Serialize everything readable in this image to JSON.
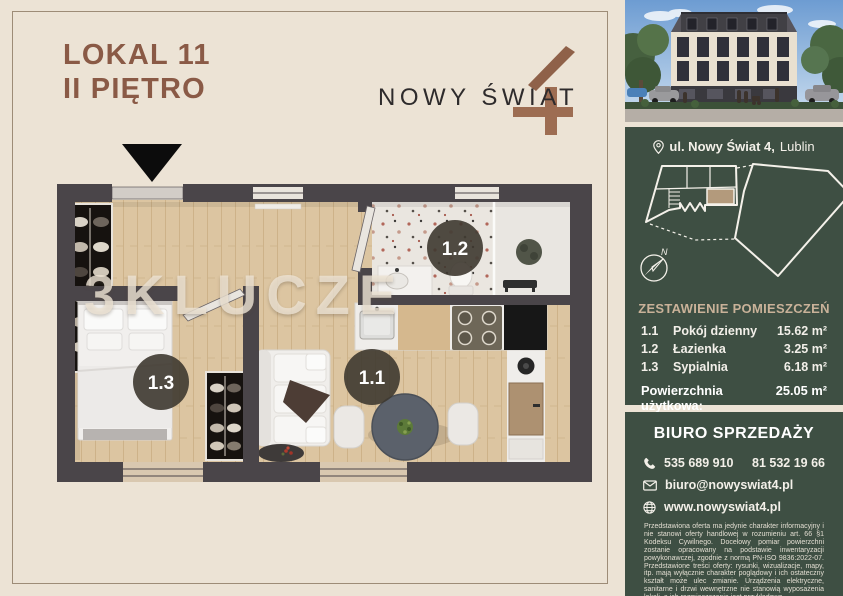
{
  "colors": {
    "background": "#ece3d5",
    "panel_green": "#3e4f43",
    "accent_tan": "#c9b299",
    "title_brown": "#8a5a46",
    "logo_brown": "#9d6d52",
    "wall_dark": "#4a4549",
    "wood_floor": "#dcc5a1"
  },
  "header": {
    "line1": "LOKAL 11",
    "line2": "II PIĘTRO"
  },
  "logo": {
    "wordmark": "NOWY ŚWIAT",
    "numeral": "4"
  },
  "floorplan": {
    "watermark": "3KLUCZE",
    "badges": {
      "living": "1.1",
      "bathroom": "1.2",
      "bedroom": "1.3"
    }
  },
  "sidebar": {
    "address": {
      "street_bold": "ul. Nowy Świat 4,",
      "city": "Lublin"
    },
    "siteplan": {
      "north_label": "N"
    },
    "rooms": {
      "heading": "ZESTAWIENIE POMIESZCZEŃ",
      "rows": [
        {
          "no": "1.1",
          "name": "Pokój dzienny",
          "area": "15.62 m²"
        },
        {
          "no": "1.2",
          "name": "Łazienka",
          "area": "3.25 m²"
        },
        {
          "no": "1.3",
          "name": "Sypialnia",
          "area": "6.18 m²"
        }
      ],
      "total_label": "Powierzchnia użytkowa:",
      "total_value": "25.05 m²"
    },
    "office": {
      "heading": "BIURO SPRZEDAŻY",
      "phone_primary": "535 689 910",
      "phone_secondary": "81 532 19 66",
      "email": "biuro@nowyswiat4.pl",
      "website": "www.nowyswiat4.pl"
    },
    "disclaimer": "Przedstawiona oferta ma jedynie charakter informacyjny i nie stanowi oferty handlowej w rozumieniu art. 66 §1 Kodeksu Cywilnego. Docelowy pomiar powierzchni zostanie opracowany na podstawie inwentaryzacji powykonawczej, zgodnie z normą PN-ISO 9836:2022-07. Przedstawione treści oferty: rysunki, wizualizacje, mapy, itp. mają wyłącznie charakter poglądowy i ich ostateczny kształt może ulec zmianie. Urządzenia elektryczne, sanitarne i drzwi wewnętrzne nie stanowią wyposażenia lokali, a ich rozmieszczenie jest przykładowe."
  }
}
